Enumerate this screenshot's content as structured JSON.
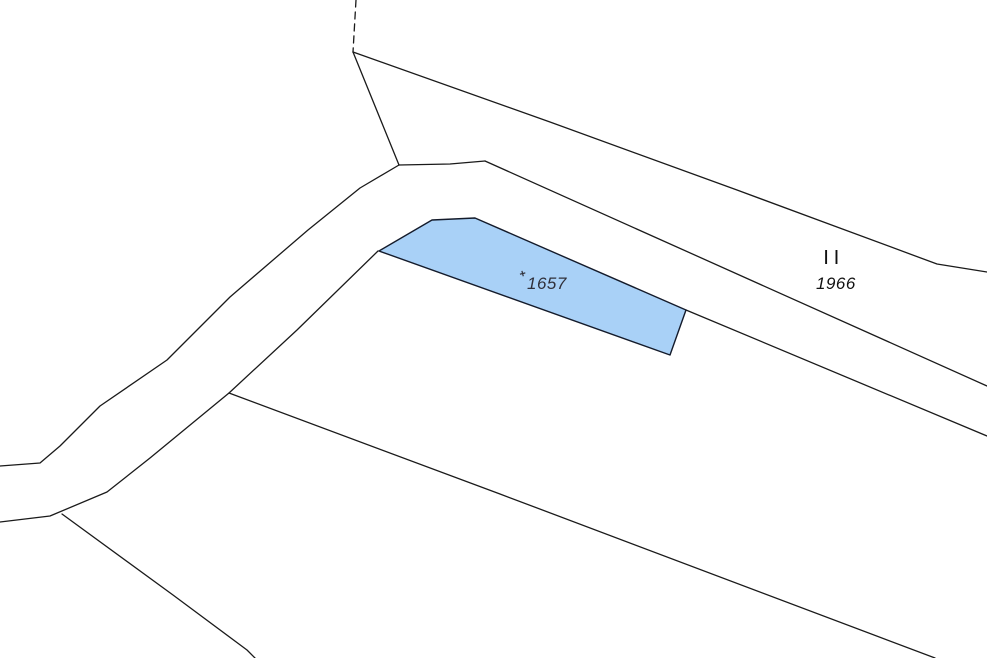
{
  "map": {
    "background_color": "#ffffff",
    "boundary_line_color": "#1a1a1a",
    "highlighted_parcel": {
      "number": "1657",
      "fill_color": "#a9d1f7",
      "stroke_color": "#141b2b",
      "label_color": "#30303a"
    },
    "neighbor_parcel": {
      "number": "1966",
      "label_color": "#111111"
    },
    "symbols": {
      "land_use_marks": "| |",
      "survey_cross": "+"
    }
  }
}
